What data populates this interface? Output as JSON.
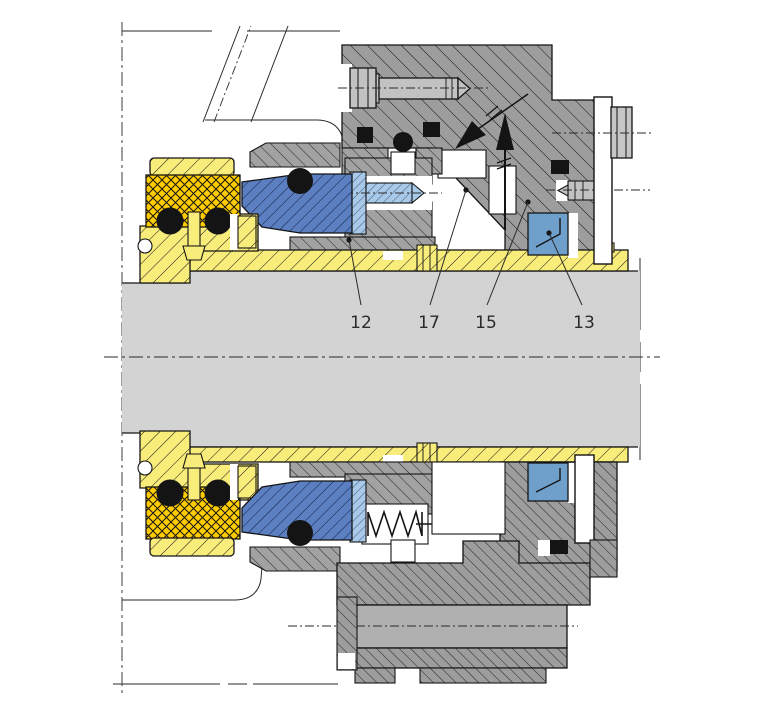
{
  "figure": {
    "type": "technical-cross-section",
    "subject": "mechanical cartridge seal assembly on pump shaft",
    "background": "#ffffff"
  },
  "part_labels": [
    {
      "text": "12"
    },
    {
      "text": "17"
    },
    {
      "text": "15"
    },
    {
      "text": "13"
    }
  ],
  "icons": {
    "flow_arrow_up": "arrow-up",
    "flow_arrow_diagonal": "arrow-diagonal-inlet"
  },
  "colors": {
    "shaft": "#d3d3d3",
    "sleeve_yellow": "#f8ec7a",
    "elastomer_yellow": "#ffcc00",
    "seal_face_blue": "#5b7fc0",
    "seat_light_blue": "#a9c9e8",
    "pilot_blue": "#6fa0cc",
    "metal_gray": "#9d9d9d",
    "metal_gray2": "#a2a2a2",
    "metal_band": "#b0b0b0",
    "metal_light": "#c2c2c2",
    "outline": "#141414",
    "label_text": "#2b2b2b"
  }
}
